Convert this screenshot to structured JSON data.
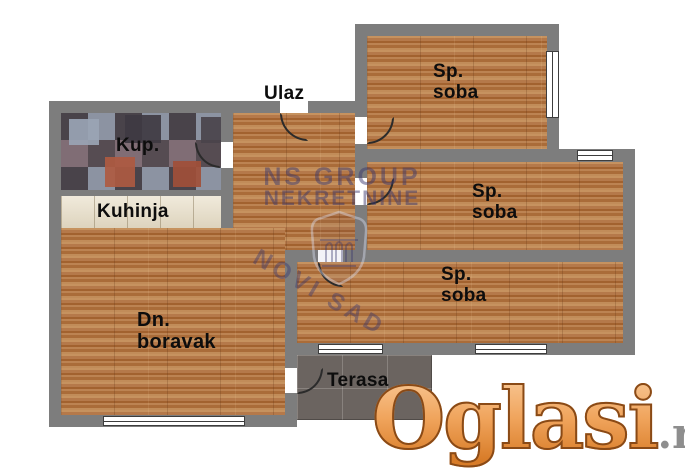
{
  "plan": {
    "entrance_label": "Ulaz",
    "rooms": {
      "bathroom": {
        "label": "Kup."
      },
      "kitchen": {
        "label": "Kuhinja"
      },
      "living_room": {
        "label": "Dn.\nboravak"
      },
      "bedroom_top": {
        "label": "Sp.\nsoba"
      },
      "bedroom_middle": {
        "label": "Sp.\nsoba"
      },
      "bedroom_bottom": {
        "label": "Sp.\nsoba"
      },
      "terrace": {
        "label": "Terasa"
      }
    }
  },
  "watermark": {
    "line1": "NS GROUP",
    "line2": "NEKRETNINE",
    "stamp": "NOVI SAD"
  },
  "brand": {
    "name": "Oglasi",
    "suffix": ".rs"
  },
  "colors": {
    "background": "#ffffff",
    "wall": "#7d7d7d",
    "wood": "#b5794a",
    "bathroom_tile_base": "#6f656b",
    "kitchen_tile": "#e9dfc8",
    "terrace_tile": "#6b6460",
    "door_line": "#2b2b2b",
    "label_text": "#0d0d0d",
    "watermark_navy": "#38376e",
    "logo_orange": "#ee9d4a",
    "logo_outline": "#8a4a16",
    "logo_suffix_gray": "#8e8e8e"
  }
}
